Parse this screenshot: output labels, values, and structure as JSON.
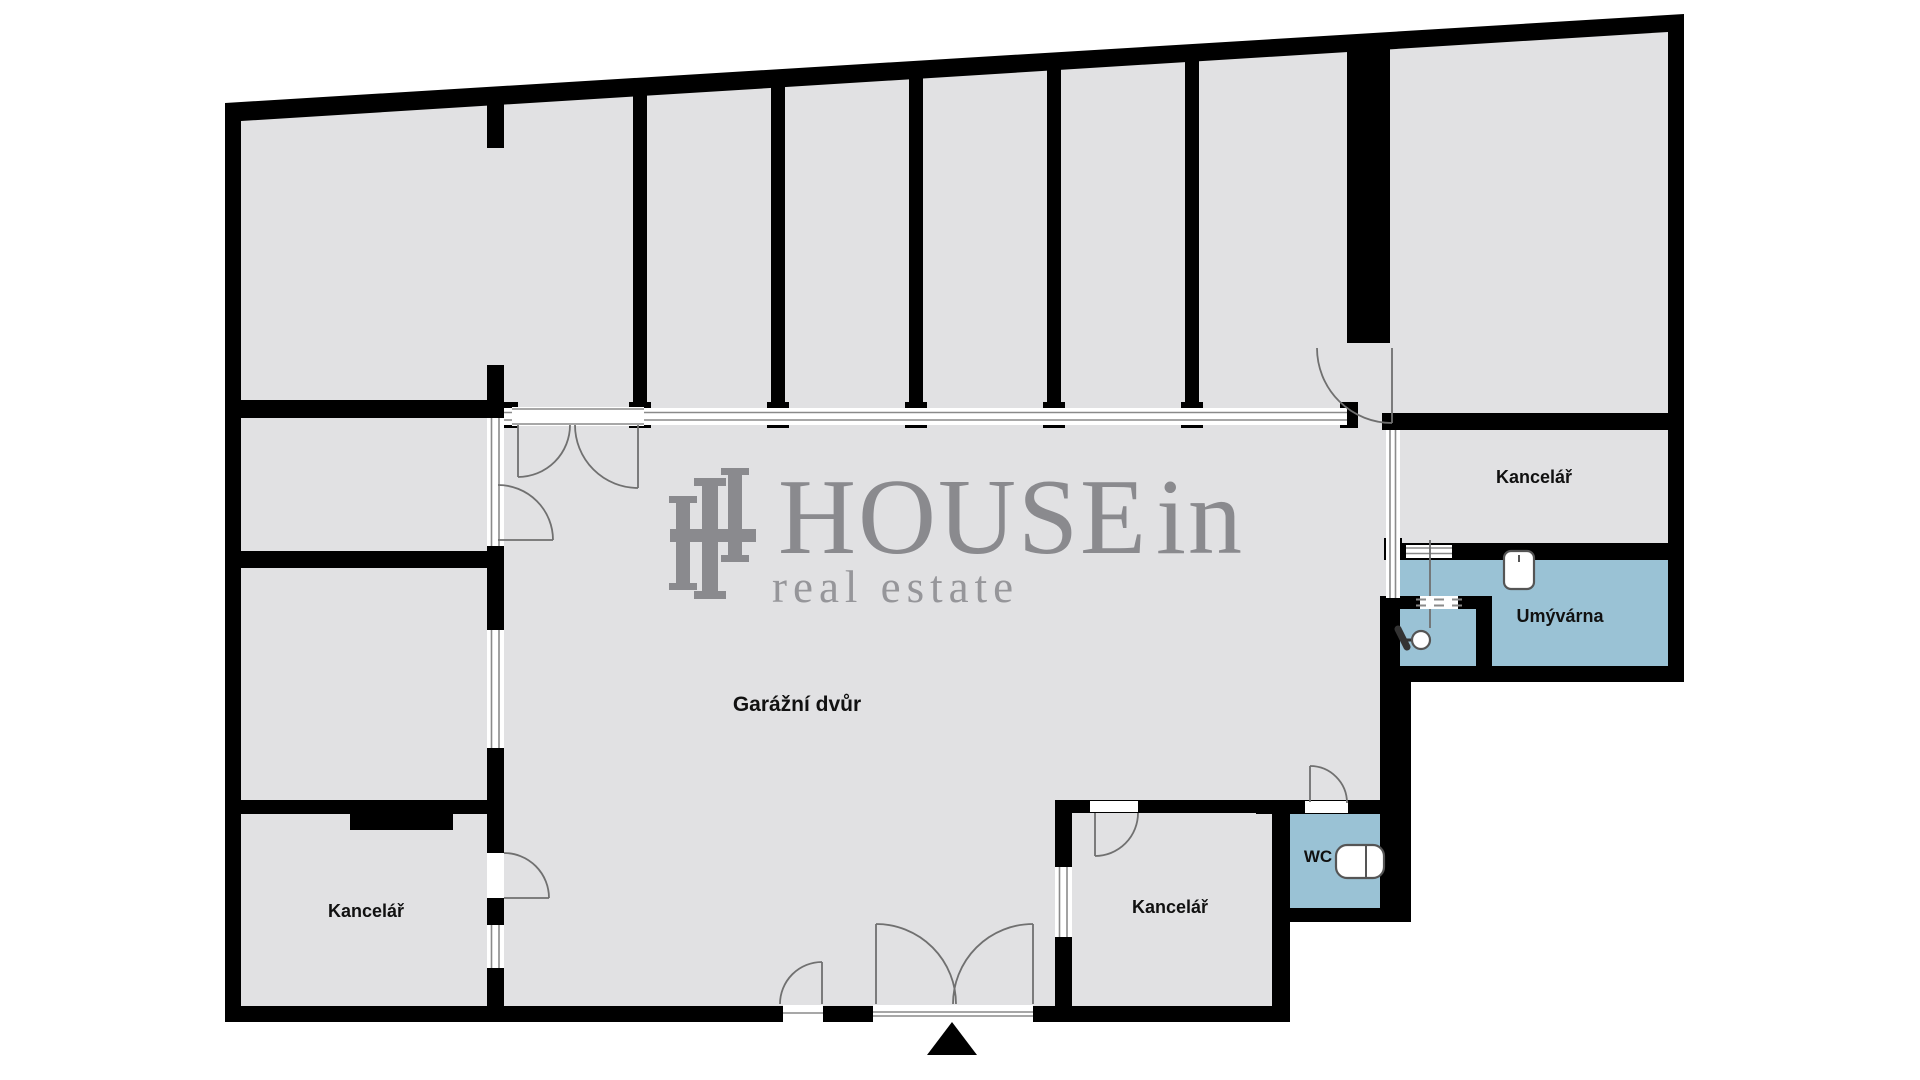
{
  "page": {
    "title": "HOUSEin real estate — floor plan"
  },
  "colors": {
    "wall": "#000000",
    "room": "#e1e1e3",
    "wet": "#9ac2d5",
    "outline": "#707070",
    "frame": "#8a8a8a",
    "logo": "#8a8a8e",
    "tagline": "#96969a",
    "label": "#111111"
  },
  "rooms": {
    "garage": "Garážní dvůr",
    "office_top_right": "Kancelář",
    "office_bottom_middle": "Kancelář",
    "office_bottom_left": "Kancelář",
    "washroom": "Umývárna",
    "wc": "WC"
  },
  "logo": {
    "word": "HOUSE",
    "suffix": "in",
    "tagline": "real estate"
  },
  "icons": {
    "entrance": "entrance-arrow-icon",
    "sink": "sink-icon",
    "faucet": "faucet-icon",
    "toilet": "toilet-icon",
    "monogram": "housein-monogram-icon"
  }
}
